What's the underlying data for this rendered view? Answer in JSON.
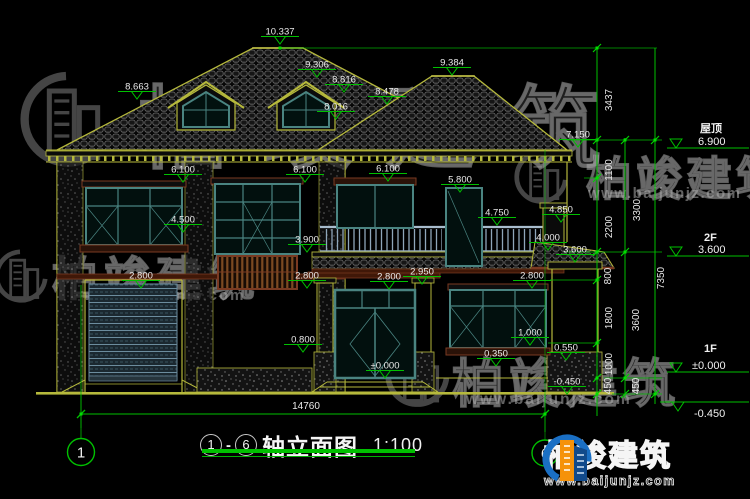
{
  "drawing": {
    "title": {
      "axis_start": "1",
      "separator": "-",
      "axis_end": "6",
      "name": "轴立面图",
      "scale": "1:100"
    },
    "bottom_dimension": "14760",
    "axis_bubbles": {
      "left": "1",
      "right": "6"
    }
  },
  "elevation_marks": [
    {
      "t": "10.337",
      "x": 280,
      "y": 31
    },
    {
      "t": "9.306",
      "x": 317,
      "y": 64
    },
    {
      "t": "8.816",
      "x": 344,
      "y": 79
    },
    {
      "t": "8.478",
      "x": 387,
      "y": 91
    },
    {
      "t": "8.016",
      "x": 336,
      "y": 106
    },
    {
      "t": "8.663",
      "x": 137,
      "y": 86
    },
    {
      "t": "9.384",
      "x": 452,
      "y": 62
    },
    {
      "t": "7.150",
      "x": 578,
      "y": 134
    },
    {
      "t": "6.100",
      "x": 183,
      "y": 169
    },
    {
      "t": "6.100",
      "x": 305,
      "y": 169
    },
    {
      "t": "6.100",
      "x": 388,
      "y": 168
    },
    {
      "t": "5.800",
      "x": 460,
      "y": 179
    },
    {
      "t": "4.500",
      "x": 183,
      "y": 219
    },
    {
      "t": "4.750",
      "x": 497,
      "y": 212
    },
    {
      "t": "4.850",
      "x": 561,
      "y": 209
    },
    {
      "t": "4.000",
      "x": 548,
      "y": 237
    },
    {
      "t": "3.900",
      "x": 307,
      "y": 239
    },
    {
      "t": "3.600",
      "x": 575,
      "y": 249
    },
    {
      "t": "2.950",
      "x": 422,
      "y": 271
    },
    {
      "t": "2.800",
      "x": 141,
      "y": 275
    },
    {
      "t": "2.800",
      "x": 307,
      "y": 275
    },
    {
      "t": "2.800",
      "x": 389,
      "y": 276
    },
    {
      "t": "2.800",
      "x": 532,
      "y": 275
    },
    {
      "t": "1.000",
      "x": 530,
      "y": 332
    },
    {
      "t": "0.800",
      "x": 303,
      "y": 339
    },
    {
      "t": "0.550",
      "x": 566,
      "y": 347
    },
    {
      "t": "0.350",
      "x": 496,
      "y": 353
    },
    {
      "t": "±0.000",
      "x": 385,
      "y": 365
    },
    {
      "t": "-0.450",
      "x": 567,
      "y": 381
    }
  ],
  "right_dims": {
    "chain_inner": [
      "3437",
      "1100",
      "2200",
      "800",
      "1800",
      "1000",
      "450"
    ],
    "chain_mid": [
      "3300",
      "3600",
      "450"
    ],
    "chain_outer": [
      "7350"
    ]
  },
  "levels": [
    {
      "label": "屋顶",
      "value": "6.900"
    },
    {
      "label": "2F",
      "value": "3.600"
    },
    {
      "label": "1F",
      "value": "±0.000"
    },
    {
      "label": "",
      "value": "-0.450"
    }
  ],
  "brand": {
    "name": "柏竣建筑",
    "url": "www.baijunjz.com"
  },
  "colors": {
    "wall_yellow": "#b6b93c",
    "dim_green": "#00c000",
    "window_teal": "#4a8481",
    "trim_maroon": "#7a3a22",
    "text_white": "#eaeaea",
    "logo_blue": "#1a6fc4",
    "logo_orange": "#f5920a"
  }
}
